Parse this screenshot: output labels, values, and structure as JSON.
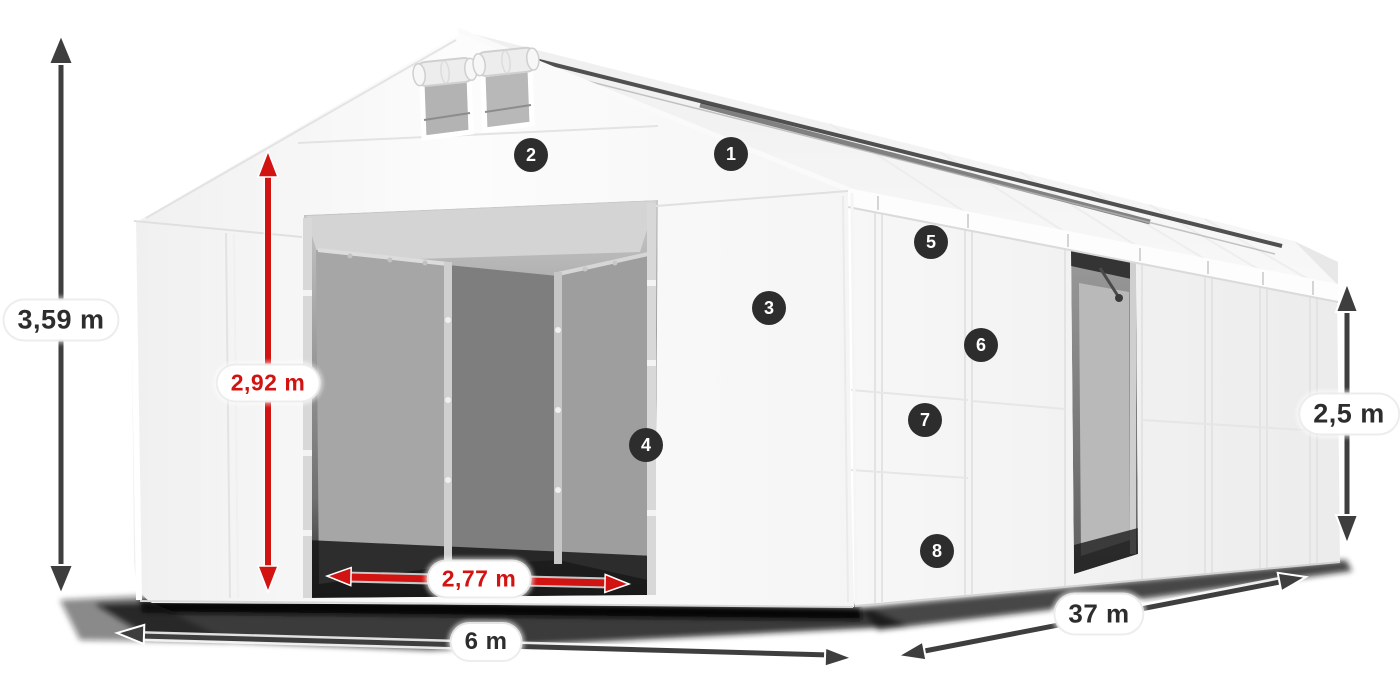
{
  "diagram": {
    "title": "tent-dimension-diagram",
    "markers": [
      "1",
      "2",
      "3",
      "4",
      "5",
      "6",
      "7",
      "8"
    ],
    "dimensions": {
      "total_height": "3,59 m",
      "door_height": "2,92 m",
      "door_width": "2,77 m",
      "width": "6 m",
      "length": "37 m",
      "side_height": "2,5 m"
    },
    "colors": {
      "accent_red": "#d11312",
      "arrow_dark": "#3e3e3e",
      "badge_bg": "#2d2d2d",
      "badge_text": "#ffffff",
      "label_bg": "#ffffff",
      "label_text_dark": "#2d2d2d",
      "tent_white": "#f8f8f8",
      "interior_gray": "#8f8f8f"
    }
  }
}
